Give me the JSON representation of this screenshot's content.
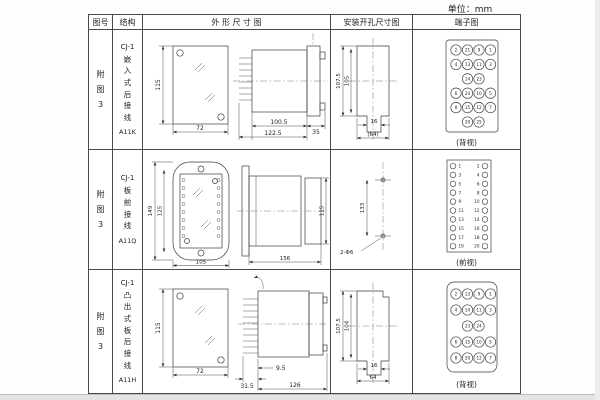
{
  "unit_label": "单位：mm",
  "headers": {
    "fig_no": "图号",
    "structure": "结构",
    "outline": "外 形 尺 寸 图",
    "mounting": "安装开孔尺寸图",
    "terminal": "端子图"
  },
  "rows": [
    {
      "fig_no": "附图3",
      "model": "CJ-1",
      "structure": "嵌入式后接线",
      "code": "A11K",
      "outline": {
        "front_h": "115",
        "front_w": "72",
        "body_d": "100.5",
        "total_d": "122.5",
        "flange_d": "35"
      },
      "mounting": {
        "outer_h": "107.5",
        "inner_h": "105",
        "slot_w": "16",
        "width": "(64)"
      },
      "terminal": {
        "view": "(背视)",
        "grid": [
          [
            "2",
            "21",
            "9",
            "1"
          ],
          [
            "4",
            "13",
            "11",
            "3"
          ],
          [
            "",
            "14",
            "23",
            ""
          ],
          [
            "6",
            "24",
            "10",
            "5"
          ],
          [
            "8",
            "15",
            "12",
            "7"
          ],
          [
            "",
            "20",
            "25",
            ""
          ]
        ]
      }
    },
    {
      "fig_no": "附图3",
      "model": "CJ-1",
      "structure": "板前接线",
      "code": "A11Q",
      "outline": {
        "outer_h": "149",
        "inner_h": "125",
        "front_w": "105",
        "total_d": "156",
        "side_h": "115"
      },
      "mounting": {
        "hole_pitch": "133",
        "holes": "2-Φ6"
      },
      "terminal": {
        "view": "(前视)",
        "left": [
          "1",
          "3",
          "5",
          "7",
          "9",
          "11",
          "13",
          "15",
          "17",
          "19"
        ],
        "right": [
          "2",
          "4",
          "6",
          "8",
          "10",
          "12",
          "14",
          "16",
          "18",
          "20"
        ]
      }
    },
    {
      "fig_no": "附图3",
      "model": "CJ-1",
      "structure": "凸出式板后接线",
      "code": "A11H",
      "outline": {
        "front_h": "115",
        "front_w": "72",
        "pin_d": "31.5",
        "panel_d": "9.5",
        "total_d": "126"
      },
      "mounting": {
        "outer_h": "107.5",
        "inner_h": "104",
        "slot_w": "16",
        "width": "64"
      },
      "terminal": {
        "view": "(背视)",
        "grid": [
          [
            "2",
            "13",
            "9",
            "1"
          ],
          [
            "4",
            "14",
            "11",
            "3"
          ],
          [
            "",
            "23",
            "24",
            ""
          ],
          [
            "6",
            "15",
            "10",
            "5"
          ],
          [
            "8",
            "20",
            "12",
            "7"
          ]
        ]
      }
    }
  ]
}
